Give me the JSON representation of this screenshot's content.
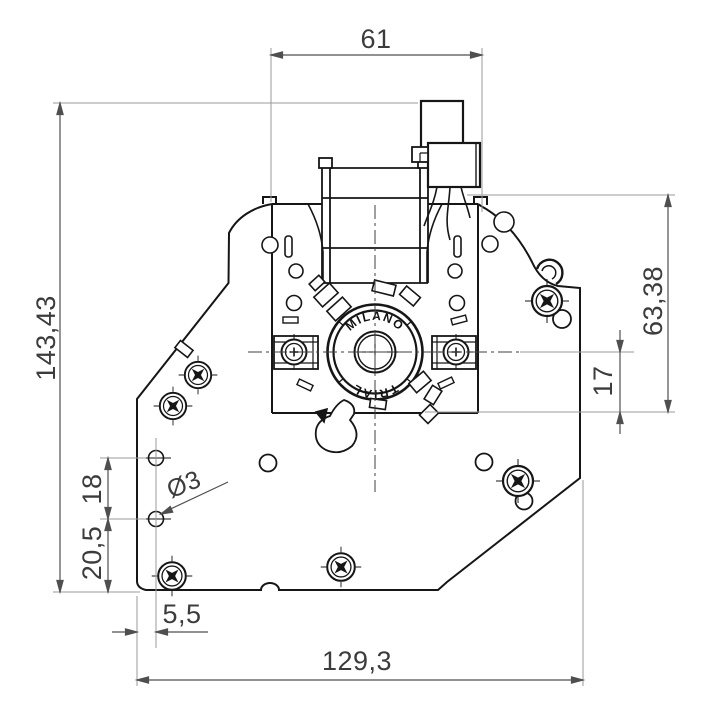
{
  "drawing": {
    "kind": "motor-technical-dimension-drawing",
    "dimensions": {
      "top_width": "61",
      "overall_height": "143,43",
      "motor_height": "63,38",
      "center_offset": "17",
      "hole_pitch": "18",
      "hole_base_offset": "20,5",
      "hole_edge_offset": "5,5",
      "overall_width": "129,3",
      "hole_diameter": "Ø3"
    },
    "rotor_labels": {
      "top": "MILANO",
      "bottom": "TRIAL"
    },
    "colors": {
      "part_line": "#161616",
      "dimension_line": "#4f4f4f",
      "extension_line": "#9a9a9a",
      "text": "#3c3c3c",
      "background": "#ffffff"
    }
  }
}
